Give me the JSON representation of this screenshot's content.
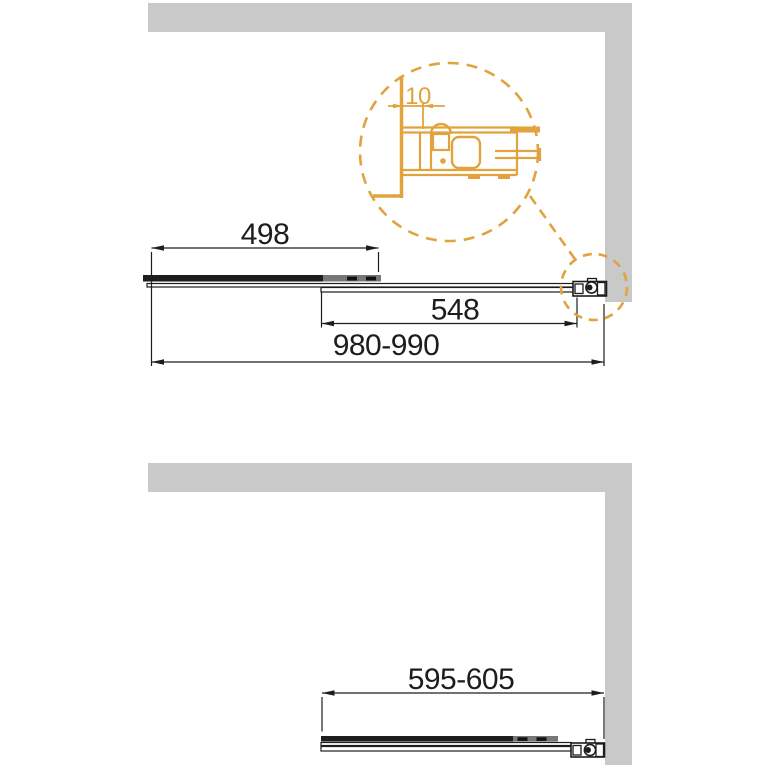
{
  "drawing": {
    "colors": {
      "wall_gray": "#c9c9c9",
      "line_black": "#1d1d1d",
      "overlap_gray": "#777777",
      "accent_orange": "#e2a23e"
    },
    "top_view": {
      "fixed_panel_width_label": "498",
      "sliding_panel_width_label": "548",
      "total_width_label": "980-990",
      "detail": {
        "gap_label": "10"
      }
    },
    "bottom_view": {
      "panel_width_label": "595-605"
    }
  }
}
